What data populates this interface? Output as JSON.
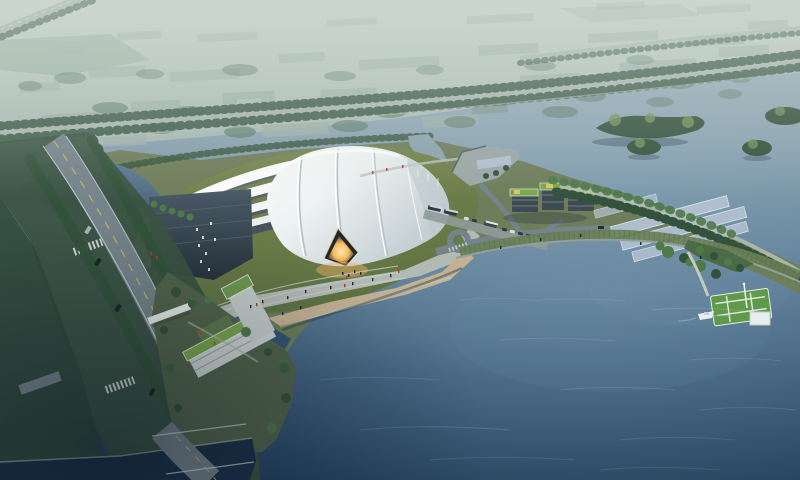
{
  "scene": {
    "label": "Aerial dusk rendering of a white shell-roofed arena beside a lake, with city haze, tree-lined boulevard, promenade, pier and boat",
    "objects": [
      "distant-city",
      "tree-lined-highway",
      "river",
      "wooded-islands",
      "arena-shell-roof",
      "arena-ribbed-shells",
      "arena-dark-facade",
      "glowing-entrance",
      "lawn-mound",
      "waterfront-plaza",
      "sand-beach",
      "parking-row",
      "roundabout",
      "marina-dock",
      "office-buildings-green-roofs",
      "glass-canopies",
      "lakeside-promenade",
      "pier-lawn-platform",
      "gazebo",
      "boat",
      "boulevard",
      "bridge",
      "channel",
      "l-shaped-building",
      "entry-canopy",
      "lake"
    ]
  },
  "palette": {
    "haze-top": "#c9d4cd",
    "haze-bottom": "#a3b6af",
    "city-building": "#9db0a9",
    "city-building-dark": "#7f938c",
    "city-tree": "#5d7c6a",
    "hedge": "#3f5d4b",
    "road-light": "#a9b6b1",
    "asphalt": "#75838a",
    "water-top": "#a3b5be",
    "water-upper": "#87a0ae",
    "water-mid": "#5d7d96",
    "water-lower": "#3a5a78",
    "water-deep": "#24415d",
    "river-inlet": "#8aa2b0",
    "pond-top": "#5e7b93",
    "pond-bottom": "#39546d",
    "channel": "#2c4864",
    "lake-corner": "#1c3148",
    "shell-white": "#fbfcfb",
    "shell-shade": "#c4cfd3",
    "rib-gap": "#505d66",
    "facade-top": "#4a5a66",
    "facade-bottom": "#27333c",
    "lawn": "#75854e",
    "lawn-dark": "#5f7342",
    "site-green": "#6e7d5a",
    "plaza": "#b3bab4",
    "sand": "#c3b193",
    "glow-core": "#ffe9b0",
    "glow-mid": "#f6b95c",
    "tree-dark": "#33523b",
    "tree-bright": "#4e7a4a",
    "forest": "#3b5342",
    "slope-green": "#6a7f57",
    "bldg-dark": "#3d4b52",
    "roof-green": "#79a64e",
    "roof-yellow": "#d9c35e",
    "glass-blue": "#b3c2d3",
    "pier-green": "#5f9a4a",
    "boat-white": "#e8eef0",
    "wall-stone": "#93a096",
    "lane-yellow": "#c9ae5c",
    "line-white": "#d8dfdb",
    "people-red": "#b0402f",
    "people-dark": "#1f2a31"
  }
}
